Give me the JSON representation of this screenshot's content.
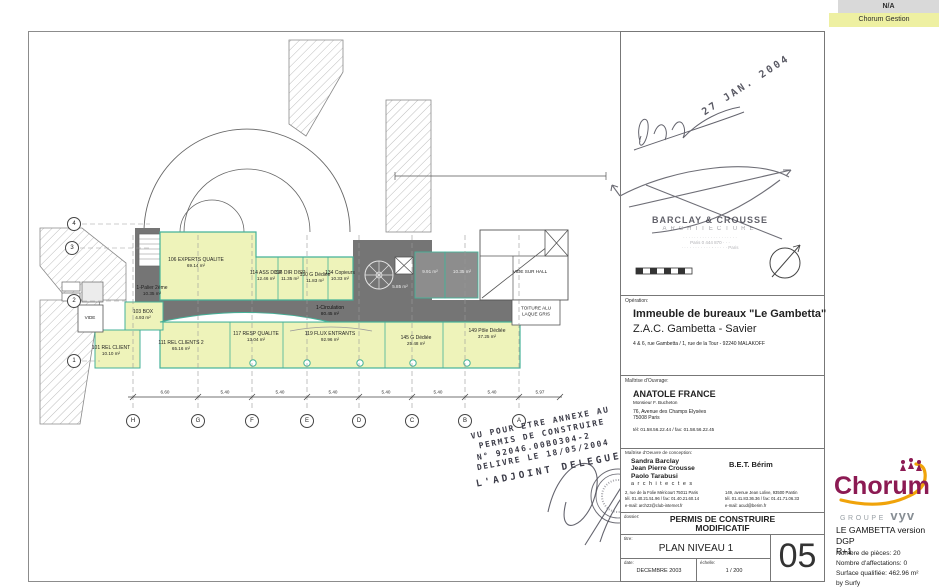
{
  "tabs": {
    "na": "N/A",
    "gestion": "Chorum Gestion"
  },
  "colors": {
    "accent_teal": "#45b299",
    "plan_fill": "#eef3ba",
    "core_gray": "#757575",
    "tab_yellow": "#eef0a2",
    "tab_gray": "#d9d9d9",
    "brand_maroon": "#8c1a53",
    "brand_orange": "#f0a30a",
    "vyv_gray": "#878e94"
  },
  "branding": {
    "logo": "Chorum",
    "groupe": "GROUPE",
    "vyv": "vyv",
    "project_line1": "LE GAMBETTA version DGP",
    "project_line2": "R+1",
    "stat1": "Nombre de pièces: 20",
    "stat2": "Nombre d'affectations: 0",
    "stat3": "Surface qualifiée: 462.96 m²",
    "stat4": "by Surfy"
  },
  "titleblock": {
    "operation_label": "Opération:",
    "operation_line1": "Immeuble de bureaux \"Le Gambetta\"",
    "operation_line2": "Z.A.C.  Gambetta - Savier",
    "operation_address": "4 & 6, rue Gambetta / 1, rue de la Tour    -    92240 MALAKOFF",
    "owner_label": "Maîtrise d'Ouvrage:",
    "owner_name": "ANATOLE  FRANCE",
    "owner_contact": "Monsieur  F. Bucheton",
    "owner_address1": "76, Avenue des Champs Elysées",
    "owner_address2": "75008 Paris",
    "owner_phone": "tél: 01.58.56.22.44 / fax: 01.58.56.22.45",
    "architect_label": "Maîtrise d'Oeuvre de conception:",
    "architect_name1": "Sandra Barclay",
    "architect_name2": "Jean Pierre Crousse",
    "architect_name3": "Paolo Tarabusi",
    "architect_title": "a r c h i t e c t e s",
    "architect_address": "2, rue de la Folie Méricourt 75011 Paris",
    "architect_phone": "tél. 01.40.21.51.96 / fax: 01.40.21.60.14",
    "architect_email": "e-mail:   arch22@club-internet.fr",
    "bet_name": "B.E.T.  Bérim",
    "bet_address": "149, avenue Jean Lolive,  93500 Pantin",
    "bet_phone": "tél. 01.41.83.36.36 / fax: 01.41.71.06.33",
    "bet_email": "e-mail:   acud@berim.fr",
    "dossier_label": "dossier:",
    "dossier_line1": "PERMIS DE CONSTRUIRE",
    "dossier_line2": "MODIFICATIF",
    "titre_label": "titre:",
    "titre": "PLAN NIVEAU  1",
    "date_label": "date:",
    "date": "DECEMBRE  2003",
    "echelle_label": "échelle:",
    "echelle": "1 / 200",
    "sheet_number": "05"
  },
  "stamps": {
    "date_stamp": "27 JAN. 2004",
    "agency_name": "BARCLAY & CROUSSE",
    "agency_type": "ARCHITECTURE",
    "agency_line3": "· · · · ·  · · · · · · · ·  · ·  · · · · ·",
    "agency_line4": "Paris  0 444 870 · · ·",
    "agency_line5": "· · ·  · · · · · · · ·  -  · · · · ·  Paris"
  },
  "vu_stamp": {
    "l1": "VU POUR ETRE ANNEXE AU",
    "l2": "PERMIS DE CONSTRUIRE",
    "l3": "N° 92046.00B0304-2",
    "l4": "DELIVRE LE 18/05/2004",
    "l5": "L'ADJOINT DELEGUE"
  },
  "plan": {
    "rooms": [
      {
        "label": "106 EXPERTS QUALITE",
        "area": "69.14 m²"
      },
      {
        "label": "1-Palier 2ème",
        "area": "10.35 m²"
      },
      {
        "label": "103 BOX",
        "area": "4.93 m²"
      },
      {
        "label": "VIDE",
        "area": ""
      },
      {
        "label": "101 REL CLIENT",
        "area": "10.10 m²"
      },
      {
        "label": "111 REL CLIENTS 2",
        "area": "65.16 m²"
      },
      {
        "label": "114 ASS DISP",
        "area": "12.46 m²"
      },
      {
        "label": "116 DIR DISP",
        "area": "11.35 m²"
      },
      {
        "label": "130 G Dédiée",
        "area": "11.83 m²"
      },
      {
        "label": "134 Copieurs",
        "area": "10.33 m²"
      },
      {
        "label": "1-Circulation",
        "area": "80.45 m²"
      },
      {
        "label": "117 RESP QUALITE",
        "area": "13.04 m²"
      },
      {
        "label": "119 FLUX ENTRANTS",
        "area": "92.96 m²"
      },
      {
        "label": "145 G Dédiée",
        "area": "25.48 m²"
      },
      {
        "label": "149 Pôle Dédiée",
        "area": "37.25 m²"
      },
      {
        "label": "VIDE SUR HALL",
        "area": ""
      },
      {
        "label": "TOITURE ALU",
        "area": "LAQUE GRIS"
      },
      {
        "label": "",
        "area": "9.91 m²"
      },
      {
        "label": "",
        "area": "10.35 m²"
      },
      {
        "label": "",
        "area": "5.85 m²"
      }
    ],
    "axis_letters": [
      "H",
      "G",
      "F",
      "E",
      "D",
      "C",
      "B",
      "A"
    ],
    "axis_numbers": [
      "4",
      "3",
      "2",
      "1"
    ],
    "dims": [
      "6.60",
      "5.40",
      "5.40",
      "5.40",
      "5.40",
      "5.40",
      "5.40",
      "5.97"
    ]
  }
}
